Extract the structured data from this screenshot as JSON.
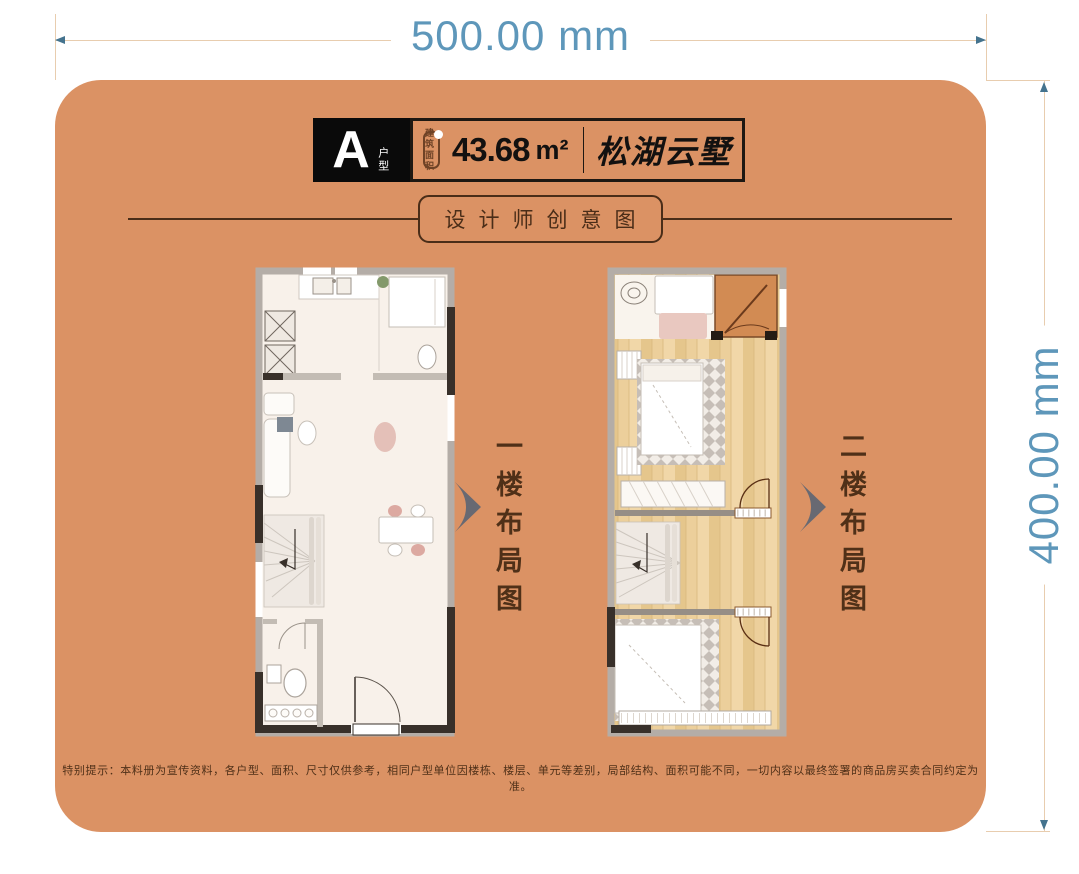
{
  "dimension_annotations": {
    "width_label": "500.00 mm",
    "height_label": "400.00 mm"
  },
  "header": {
    "unit_type": "A",
    "unit_type_suffix": "户型",
    "area_stamp_line1": "建筑",
    "area_stamp_line2": "面积",
    "area_value": "43.68",
    "area_unit": "m²",
    "project_name": "松湖云墅"
  },
  "section_title": "设计师创意图",
  "floor_labels": {
    "floor1": "一楼布局图",
    "floor2": "二楼布局图"
  },
  "disclaimer": "特别提示：本料册为宣传资料，各户型、面积、尺寸仅供参考，相同户型单位因楼栋、楼层、单元等差别，局部结构、面积可能不同，一切内容以最终签署的商品房买卖合同约定为准。",
  "colors": {
    "card_bg": "#DB9264",
    "dimension_text": "#5E97BA",
    "dimension_line": "#E8CDAF",
    "arrow": "#44738E",
    "header_black": "#0A0A0A",
    "title_brown": "#4A2D18",
    "label_brown": "#4F3018",
    "chevron": "#686972",
    "wall_gray": "#B4ADA7",
    "wall_dark": "#38302A",
    "wood_floor": "#ECCF9B",
    "plan_background": "#F8F1EA"
  }
}
